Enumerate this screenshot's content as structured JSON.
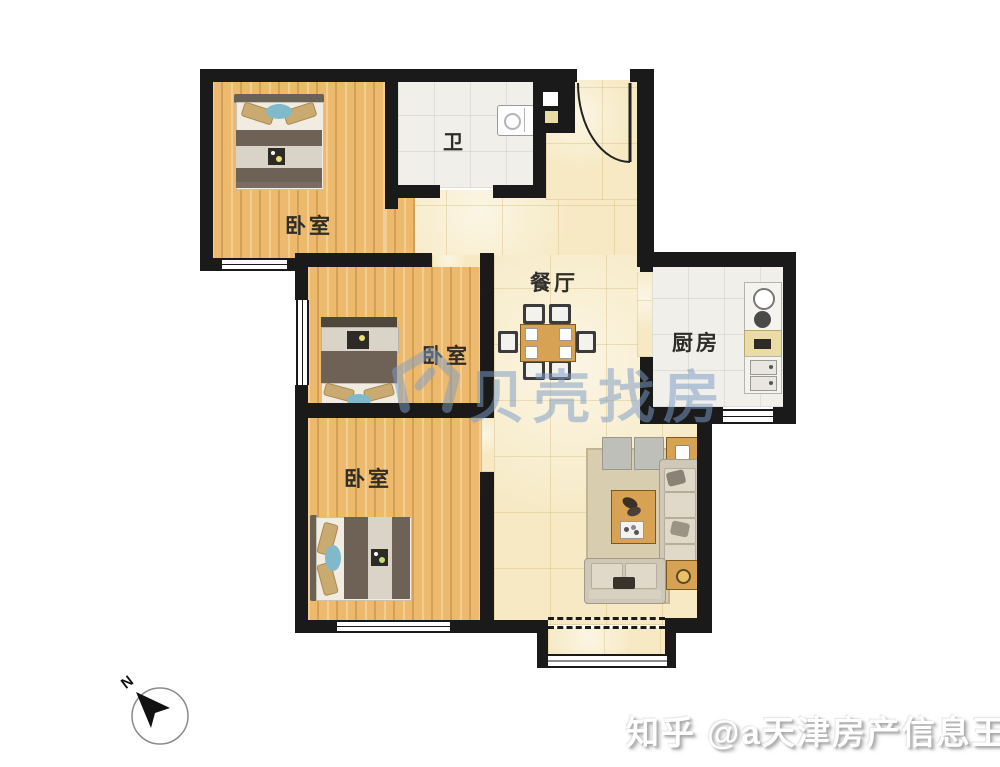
{
  "floorplan": {
    "rooms": [
      {
        "id": "bedroom-top-left",
        "label": "卧室"
      },
      {
        "id": "bathroom",
        "label": "卫"
      },
      {
        "id": "bedroom-middle",
        "label": "卧室"
      },
      {
        "id": "dining",
        "label": "餐厅"
      },
      {
        "id": "kitchen",
        "label": "厨房"
      },
      {
        "id": "bedroom-bottom",
        "label": "卧室"
      }
    ]
  },
  "compass": {
    "north_label": "N"
  },
  "watermarks": {
    "center_brand": "贝壳找房",
    "bottom_credit": "知乎 @a天津房产信息王"
  },
  "colors": {
    "wall": "#1a1a1a",
    "wood_floor": "#edb96d",
    "tile_floor": "#f6e9c3",
    "white_tile": "#f0efe9",
    "furniture_tan": "#d7a254",
    "sofa": "#cfc8b8",
    "watermark_blue": "#7d9ec8"
  }
}
